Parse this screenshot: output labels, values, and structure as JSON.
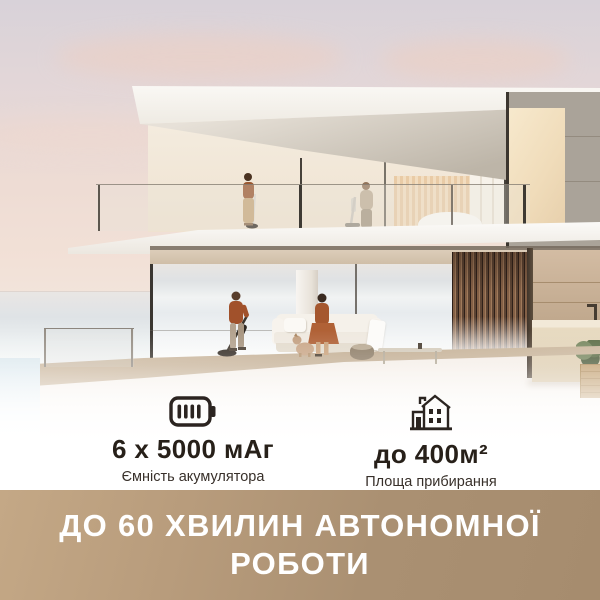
{
  "features": {
    "battery": {
      "icon": "battery-icon",
      "value": "6 х 5000 мАг",
      "caption": "Ємність акумулятора"
    },
    "area": {
      "icon": "house-icon",
      "value": "до 400м²",
      "caption_line1": "Площа прибирання",
      "caption_line2": "на одному заряді"
    }
  },
  "banner": {
    "line1": "ДО 60 ХВИЛИН АВТОНОМНОЇ",
    "line2": "РОБОТИ",
    "background_left": "#c4a886",
    "background_right": "#a68c6e",
    "text_color": "#ffffff"
  },
  "palette": {
    "feature_text": "#272019",
    "caption_text": "#38302a",
    "icon_color": "#2b2420",
    "sky_pink": "#f0ddd4",
    "wood_slats": "#7c5a42",
    "stone_edge": "#c9b59c",
    "sea": "#e3e7ea",
    "accent_rust": "#a1512b"
  }
}
